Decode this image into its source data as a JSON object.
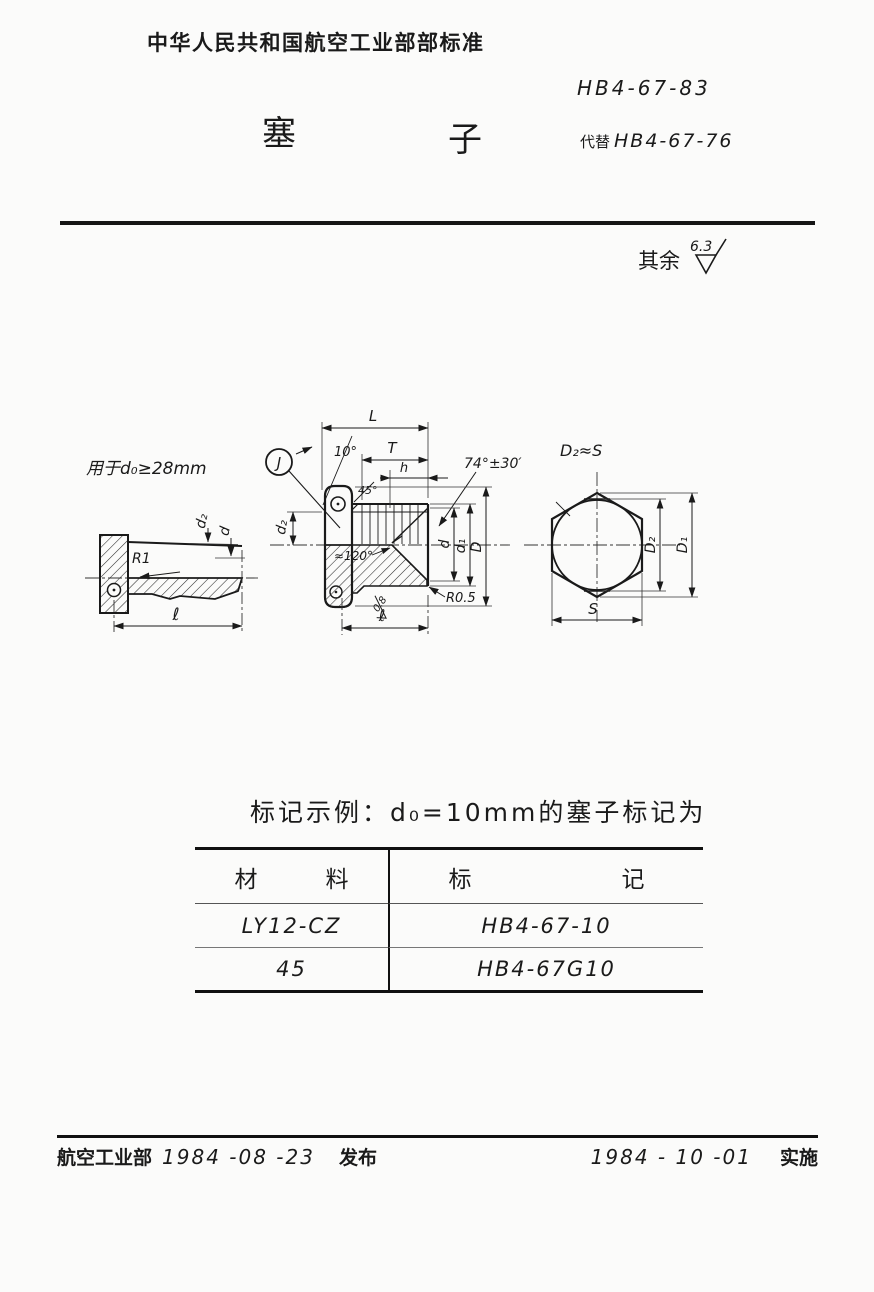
{
  "page": {
    "header": {
      "org_standard": "中华人民共和国航空工业部部标准",
      "standard_number": "HB4-67-83",
      "title_left": "塞",
      "title_right": "子",
      "replaces_label": "代替",
      "replaces_number": "HB4-67-76"
    },
    "finish": {
      "prefix": "其余",
      "value": "6.3"
    },
    "views": {
      "left": {
        "note": "用于d₀≥28mm",
        "r1": "R1",
        "d2": "d₂",
        "d": "d",
        "len": "ℓ"
      },
      "middle": {
        "L": "L",
        "angle10": "10°",
        "T": "T",
        "h": "h",
        "J": "J",
        "chamfer": "45°",
        "seat_angle": "74°±30′",
        "tip_angle": "≈120°",
        "d2": "d₂",
        "d": "d",
        "d1": "d₁",
        "D": "D",
        "radius": "R0.5",
        "rough": "0.8",
        "len": "ℓ"
      },
      "right": {
        "note": "D₂≈S",
        "D2": "D₂",
        "D1": "D₁",
        "S": "S"
      }
    },
    "marking_example": "标记示例：d₀=10mm的塞子标记为",
    "table": {
      "col1_header": "材料",
      "col2_header": "标记",
      "rows": [
        {
          "material": "LY12-CZ",
          "marking": "HB4-67-10"
        },
        {
          "material": "45",
          "marking": "HB4-67G10"
        }
      ]
    },
    "footer": {
      "issuer": "航空工业部",
      "issue_date": "1984 -08 -23",
      "issue_verb": "发布",
      "impl_date": "1984 - 10 -01",
      "impl_verb": "实施"
    }
  }
}
